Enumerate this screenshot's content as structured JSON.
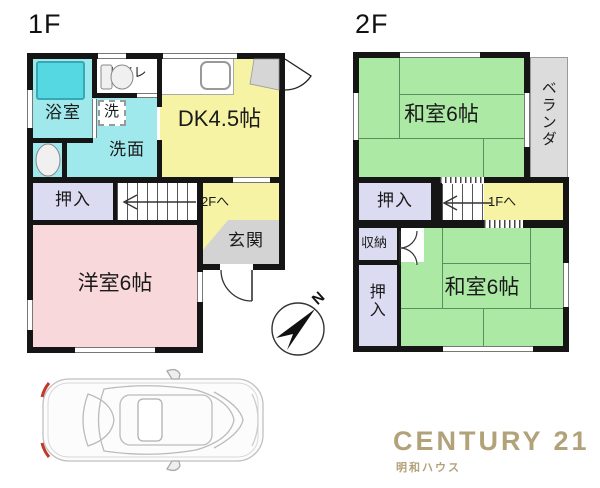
{
  "floor1": {
    "label": "1F",
    "rooms": {
      "bath": "浴室",
      "toilet": "トイレ",
      "laundry": "洗",
      "washroom": "洗面",
      "dining_kitchen": "DK4.5帖",
      "closet": "押入",
      "stairs": "2Fへ",
      "entrance": "玄関",
      "western_room": "洋室6帖"
    }
  },
  "floor2": {
    "label": "2F",
    "rooms": {
      "japanese_room_north": "和室6帖",
      "veranda": "ベランダ",
      "closet_north": "押入",
      "stairs": "1Fへ",
      "storage": "収納",
      "japanese_room_south": "和室6帖",
      "closet_south": "押入"
    }
  },
  "compass": {
    "label": "N"
  },
  "branding": {
    "company": "CENTURY 21",
    "office": "明和ハウス",
    "brand_color": "#b2a27a"
  },
  "colors": {
    "wet_area": "#9fe8ec",
    "bathtub": "#55d8e2",
    "kitchen_hall": "#f7f3a4",
    "closet": "#dbdbf2",
    "western_room": "#f8d8da",
    "japanese_room": "#ace9a5",
    "entrance": "#d3d3d3",
    "veranda": "#dcdcdc",
    "wall": "#151515",
    "tail_light": "#c0392b"
  },
  "icons": {
    "bathtub": "bathtub-icon",
    "toilet": "toilet-icon",
    "washbasin": "washbasin-icon",
    "kitchen_sink": "kitchen-sink-icon",
    "compass": "compass-icon",
    "car": "car-top-view"
  }
}
